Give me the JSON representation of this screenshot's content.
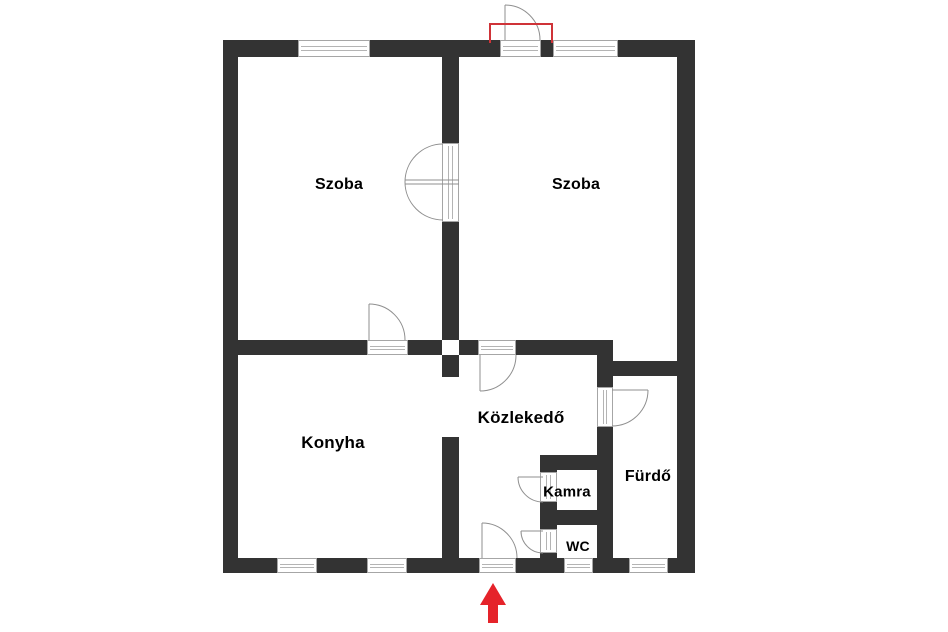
{
  "plan": {
    "title": "Apartment floor plan",
    "rooms": [
      {
        "id": "szoba-1",
        "label": "Szoba"
      },
      {
        "id": "szoba-2",
        "label": "Szoba"
      },
      {
        "id": "konyha",
        "label": "Konyha"
      },
      {
        "id": "kozlekedo",
        "label": "Közlekedő"
      },
      {
        "id": "kamra",
        "label": "Kamra"
      },
      {
        "id": "furdo",
        "label": "Fürdő"
      },
      {
        "id": "wc",
        "label": "WC"
      }
    ],
    "markers": {
      "entrance_arrow_direction": "up",
      "highlighted_door": "balcony door on top wall"
    },
    "colors": {
      "wall": "#333333",
      "opening_line": "#b4b4b4",
      "door_arc": "#8f8f8f",
      "highlight_red": "#cf3338",
      "arrow_red": "#e5232a",
      "background": "#ffffff",
      "label": "#000000"
    }
  }
}
